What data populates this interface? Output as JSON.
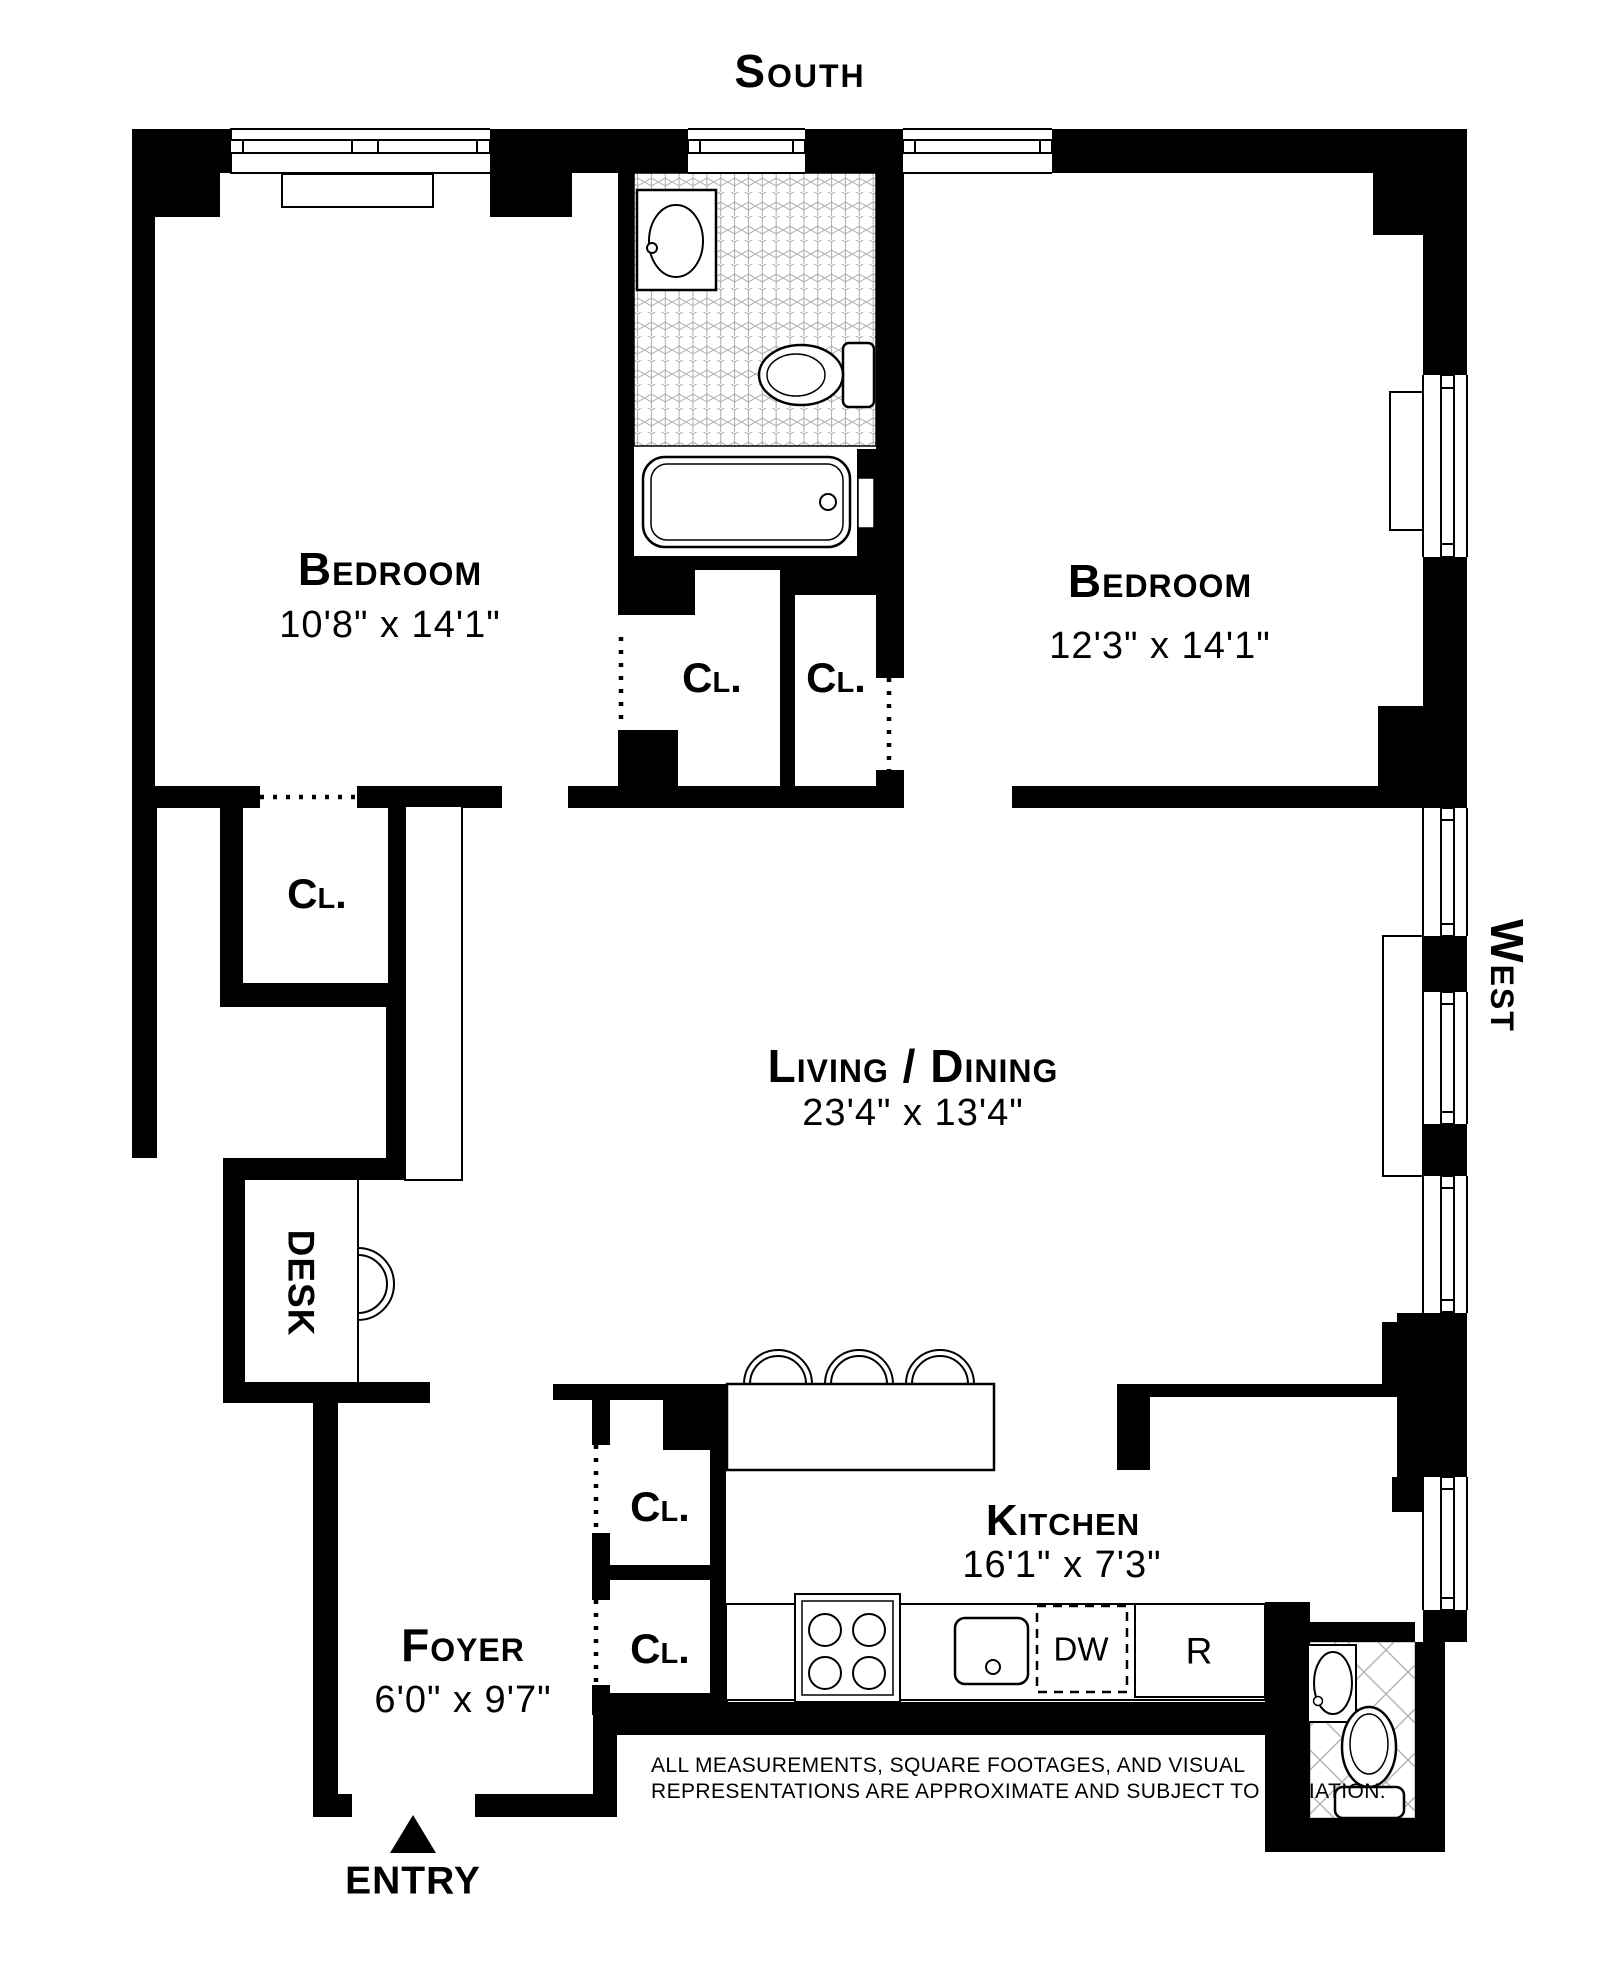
{
  "compass": {
    "south": "South",
    "west": "West"
  },
  "rooms": {
    "bedroom1": {
      "name": "Bedroom",
      "dims": "10'8\" x 14'1\""
    },
    "bedroom2": {
      "name": "Bedroom",
      "dims": "12'3\" x 14'1\""
    },
    "living": {
      "name": "Living / Dining",
      "dims": "23'4\" x 13'4\""
    },
    "kitchen": {
      "name": "Kitchen",
      "dims": "16'1\" x 7'3\""
    },
    "foyer": {
      "name": "Foyer",
      "dims": "6'0\" x 9'7\""
    },
    "desk": {
      "name": "DESK"
    },
    "entry": {
      "name": "ENTRY"
    }
  },
  "closets": {
    "bedroom1_lower": "Cl.",
    "bedroom1_side": "Cl.",
    "bedroom2_closet": "Cl.",
    "foyer_upper": "Cl.",
    "foyer_lower": "Cl."
  },
  "appliances": {
    "dishwasher": "DW",
    "refrigerator": "R"
  },
  "disclaimer": {
    "line1": "ALL MEASUREMENTS, SQUARE FOOTAGES, AND VISUAL",
    "line2": "REPRESENTATIONS ARE APPROXIMATE AND SUBJECT TO VARIATION."
  },
  "colors": {
    "wall": "#000000",
    "tile_line": "#ababab",
    "background": "#ffffff"
  }
}
